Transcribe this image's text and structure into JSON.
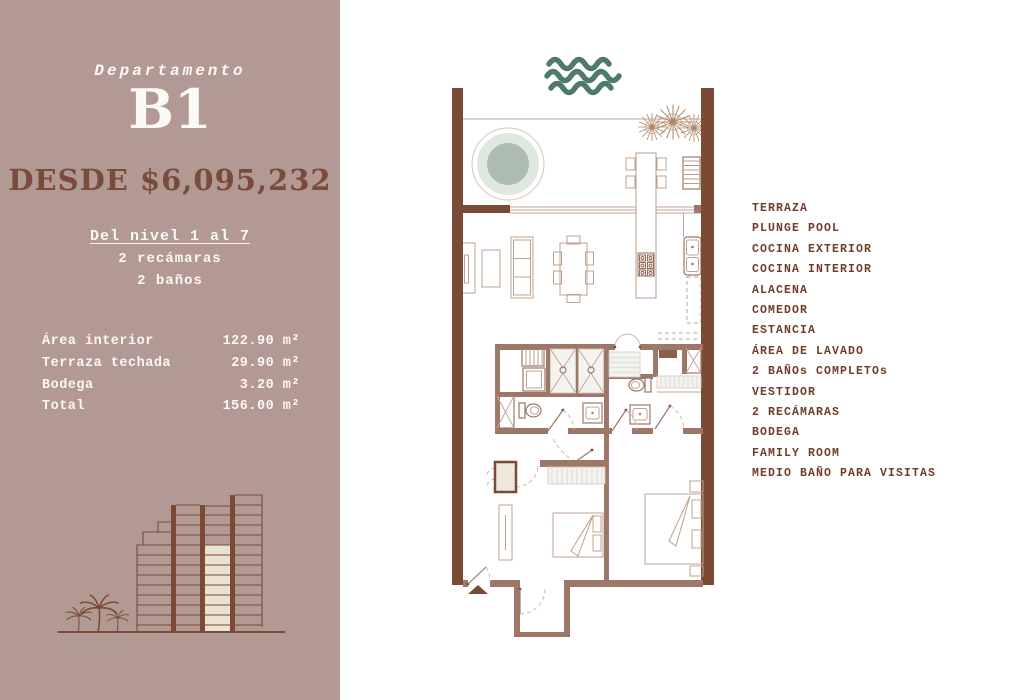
{
  "panel": {
    "label": "Departamento",
    "unit": "B1",
    "price": "DESDE $6,095,232",
    "levels": "Del nivel 1 al 7",
    "bedrooms": "2 recámaras",
    "bathrooms": "2 baños",
    "areas": [
      {
        "label": "Área interior",
        "value": "122.90 m²"
      },
      {
        "label": "Terraza techada",
        "value": "29.90 m²"
      },
      {
        "label": "Bodega",
        "value": "3.20 m²"
      },
      {
        "label": "Total",
        "value": "156.00 m²"
      }
    ]
  },
  "features": [
    "TERRAZA",
    "PLUNGE POOL",
    "COCINA EXTERIOR",
    "COCINA INTERIOR",
    "ALACENA",
    "COMEDOR",
    "ESTANCIA",
    "ÁREA DE LAVADO",
    "2 BAÑOs COMPLETOs",
    "VESTIDOR",
    "2 RECÁMARAS",
    "BODEGA",
    "FAMILY ROOM",
    "MEDIO BAÑO PARA VISITAS"
  ],
  "icons": {
    "waves": "waves-icon",
    "plants": "plant-icon",
    "palms": "palm-trees-icon",
    "building": "building-illustration",
    "entry_arrow": "entry-arrow-icon"
  },
  "colors": {
    "panel_bg": "#b29993",
    "accent_brown": "#7a4b3a",
    "list_text": "#6f3c2a",
    "wall_brown": "#7b4a36",
    "waves_green": "#4f7b6b",
    "pool_green": "#adbcb1",
    "highlight_cream": "#eae3d1",
    "text_white": "#fbf7f2"
  }
}
